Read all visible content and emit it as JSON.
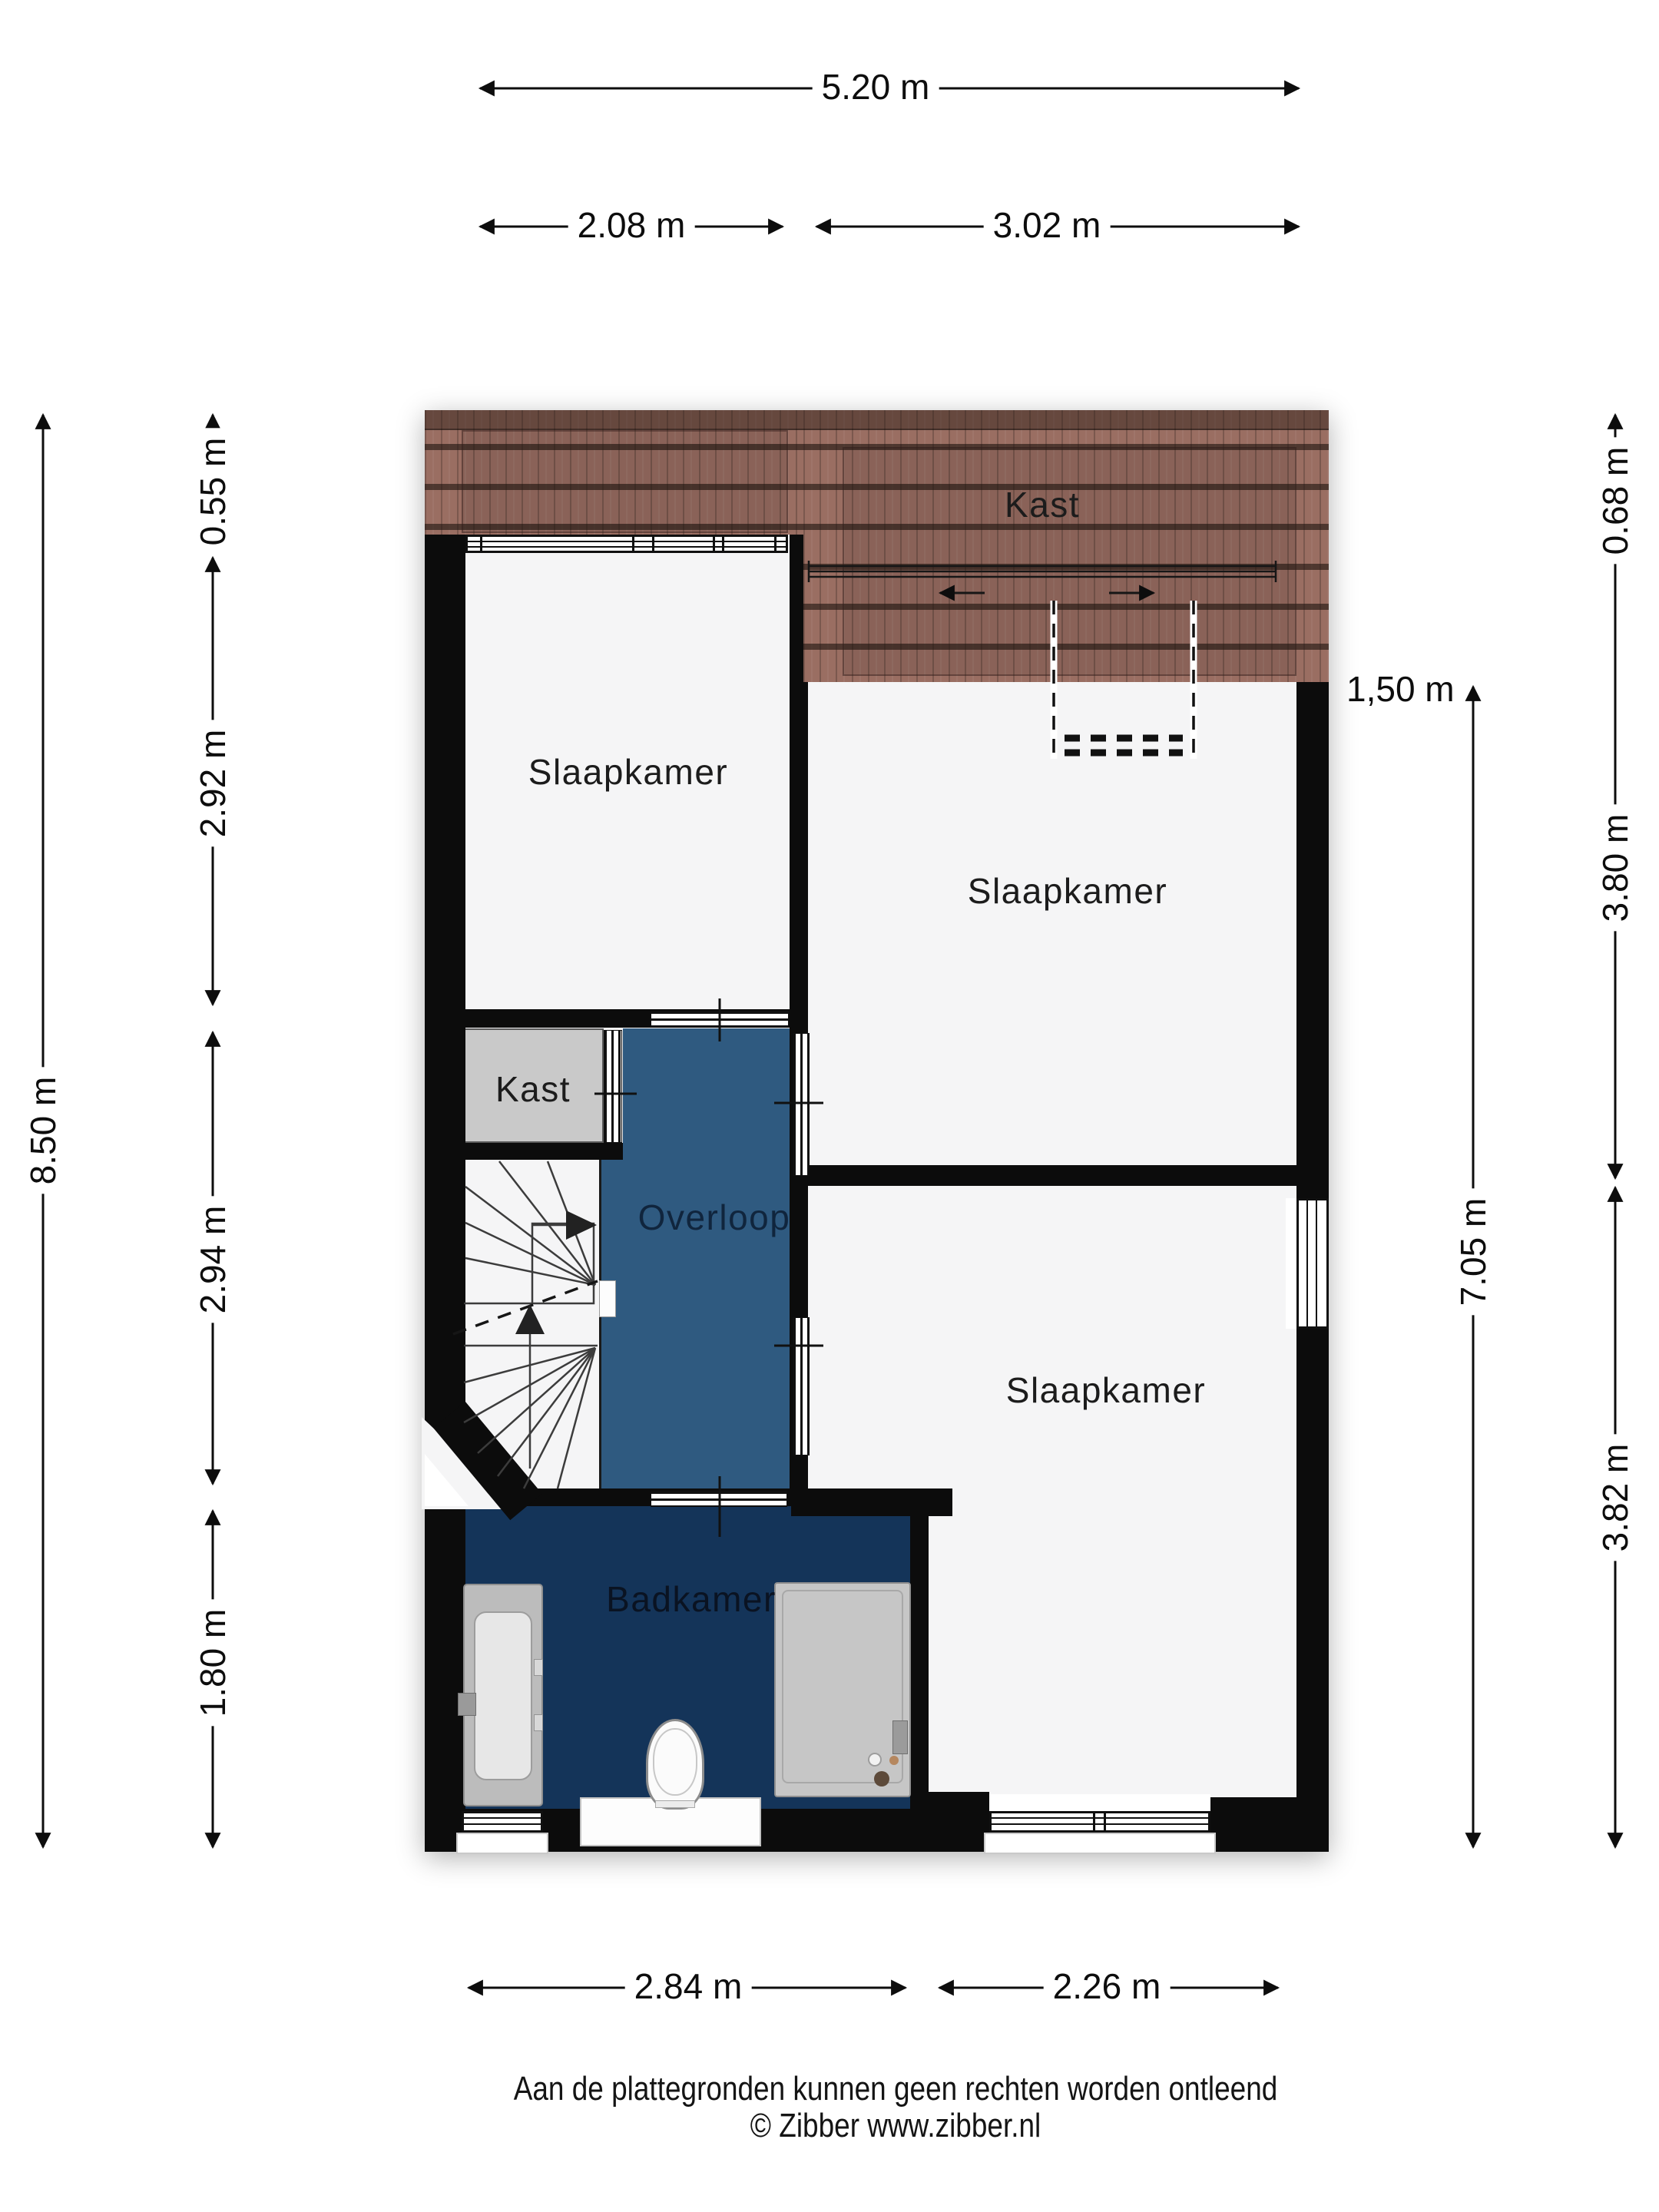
{
  "plan": {
    "type": "floorplan",
    "language": "nl",
    "rooms": {
      "slaapkamer_left": {
        "label": "Slaapkamer"
      },
      "slaapkamer_top_right": {
        "label": "Slaapkamer"
      },
      "slaapkamer_bottom_right": {
        "label": "Slaapkamer"
      },
      "kast_attic": {
        "label": "Kast"
      },
      "kast_closet": {
        "label": "Kast"
      },
      "overloop": {
        "label": "Overloop"
      },
      "badkamer": {
        "label": "Badkamer"
      }
    },
    "fixtures": [
      "bathtub",
      "toilet",
      "vanity-counter",
      "shower",
      "winder-staircase",
      "sliding-doors",
      "roof-window-dashed-outline"
    ],
    "colors": {
      "wall": "#0c0c0c",
      "room_floor": "#f5f5f6",
      "overloop_floor": "#2f5a80",
      "badkamer_floor": "#143459",
      "kast_floor": "#c9c9c9",
      "roof_tiles": "#9a6e62"
    }
  },
  "dimensions": {
    "top": {
      "total": "5.20 m",
      "left": "2.08 m",
      "right": "3.02 m"
    },
    "bottom": {
      "left": "2.84 m",
      "right": "2.26 m"
    },
    "left": {
      "total": "8.50 m",
      "segments": [
        "0.55 m",
        "2.92 m",
        "2.94 m",
        "1.80 m"
      ]
    },
    "right": {
      "inner": "7.05 m",
      "segments": [
        "0.68 m",
        "3.80 m",
        "3.82 m"
      ]
    },
    "headroom": "1,50 m"
  },
  "footer": {
    "disclaimer": "Aan de plattegronden kunnen geen rechten worden ontleend",
    "copyright": "© Zibber www.zibber.nl"
  }
}
